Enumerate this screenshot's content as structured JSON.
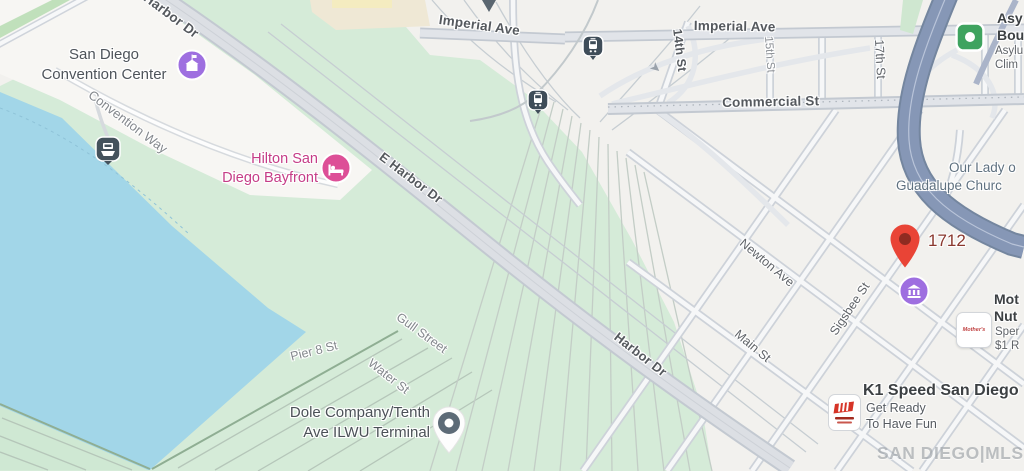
{
  "map": {
    "watermark": "SAN DIEGO|MLS",
    "colors": {
      "water": "#a2d6e8",
      "park_green": "#d5ebd8",
      "terminal_green": "#cfe8d3",
      "freeway_blue": "#8697b6",
      "road_major": "#e1e4e9",
      "pin_red": "#e94436",
      "poi_purple": "#9e6fe0",
      "hotel_pink": "#dd4f97",
      "transit_dark": "#44525c",
      "poi_green": "#3fa35f"
    },
    "streets": {
      "harbor_dr_top": "Harbor Dr",
      "e_harbor_dr": "E Harbor Dr",
      "harbor_dr": "Harbor Dr",
      "imperial_ave_w": "Imperial Ave",
      "imperial_ave_e": "Imperial Ave",
      "commercial_st": "Commercial St",
      "st_14th": "14th St",
      "st_15th": "15th St",
      "st_17th": "17th St",
      "newton_ave": "Newton Ave",
      "main_st": "Main St",
      "sigsbee_st": "Sigsbee St",
      "gull_street": "Gull Street",
      "pier_8_st": "Pier 8 St",
      "water_st": "Water St",
      "convention_way": "Convention Way"
    },
    "pois": {
      "convention_center": {
        "line1": "San Diego",
        "line2": "Convention Center"
      },
      "hilton": {
        "line1": "Hilton San",
        "line2": "Diego Bayfront"
      },
      "dole": {
        "line1": "Dole Company/Tenth",
        "line2": "Ave ILWU Terminal"
      },
      "church": {
        "line1": "Our Lady o",
        "line2": "Guadalupe Churc"
      },
      "address_1712": "1712",
      "asylum": {
        "line1": "Asy",
        "line2": "Bou",
        "line3": "Asylu",
        "line4": "Clim"
      },
      "mothers": {
        "line1": "Mot",
        "line2": "Nut",
        "line3": "Sper",
        "line4": "$1 R",
        "logo_text": "Mother's"
      },
      "k1": {
        "title": "K1 Speed San Diego",
        "sub1": "Get Ready",
        "sub2": "To Have Fun"
      }
    },
    "icons": {
      "one_way_arrow": "➤"
    }
  }
}
